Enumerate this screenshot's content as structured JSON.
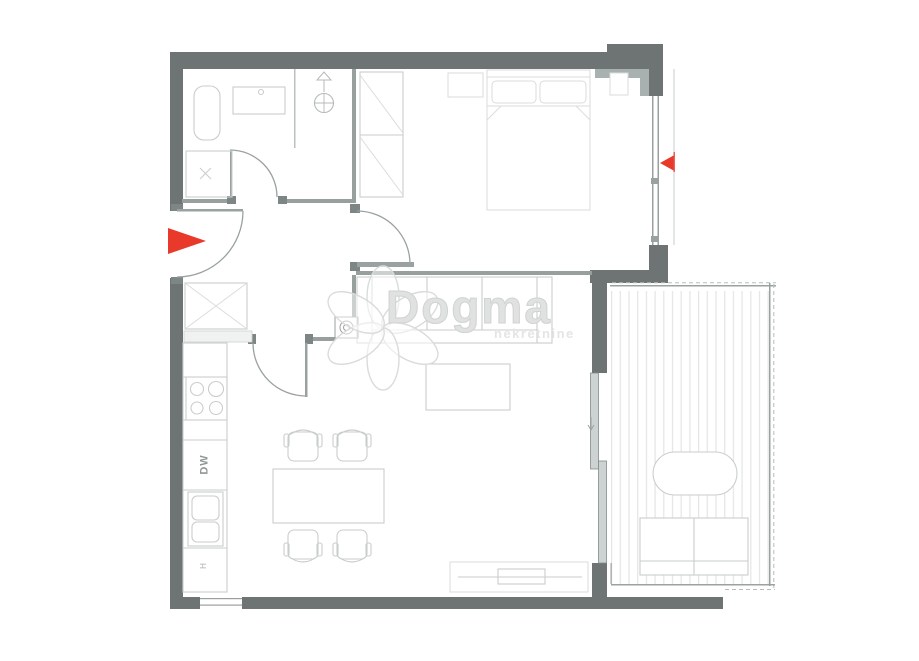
{
  "watermark": {
    "brand": "Dogma",
    "tagline": "nekretnine"
  },
  "labels": {
    "dishwasher": "DW",
    "appliance": "H"
  },
  "colors": {
    "wall": "#6d7473",
    "wallLight": "#a9b1b0",
    "line": "#98a09e",
    "jamb": "#7e8685",
    "mid": "#9aa2a1",
    "furniture": "#c9cecd",
    "faint": "#d9dddc",
    "stripe": "#e2e6e5",
    "rail": "#9aa19f",
    "glass": "#ccd3d2",
    "accentRed": "#e8392b",
    "watermark": "#d9dcdb"
  }
}
